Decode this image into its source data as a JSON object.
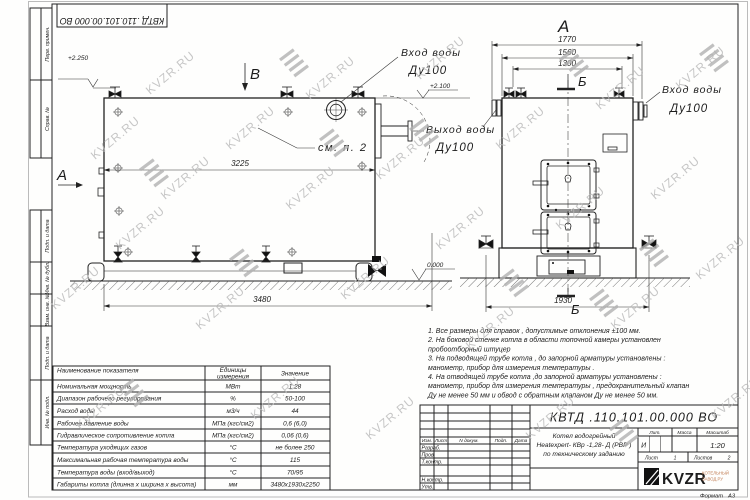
{
  "watermark": {
    "text": "KVZR.RU"
  },
  "margin_labels": [
    "Перв. примен.",
    "Справ. №",
    "Подп. и дата",
    "Инв. № дубл.",
    "Взам. инв. №",
    "Подп. и дата",
    "Инв. № подл."
  ],
  "views": {
    "a": "А",
    "b": "В",
    "sec_b": "Б",
    "callout_see_item2": "см. п. 2"
  },
  "pipe_labels": {
    "inlet": {
      "l1": "Вход воды",
      "l2": "Ду100"
    },
    "outlet": {
      "l1": "Выход воды",
      "l2": "Ду100"
    }
  },
  "elevations": {
    "vent_top": "+2.250",
    "body_top": "+2.100",
    "ground": "0.000"
  },
  "dims": {
    "body_length": "3225",
    "overall_length": "3480",
    "flange_span": "1770",
    "body_width": "1560",
    "vent_span": "1300",
    "base_span": "1930"
  },
  "notes": {
    "lines": [
      "1.  Все размеры для справок , допустимые отклонения  ±100 мм.",
      "2.  На боковой стенке котла в области топочной камеры установлен",
      "пробоотборный штуцер",
      "3.  На подводящей трубе котла , до запорной арматуры установлены :",
      "манометр, прибор для измерения температуры .",
      "4.  На отводящей трубе котла ,до запорной арматуры установлены :",
      "манометр, прибор для измерения температуры ,  предохранительный клапан",
      "Ду не менее  50 мм и обвод с обратным клапаном  Ду не менее  50 мм."
    ]
  },
  "spec_table": {
    "headers": {
      "name": "Наименование показателя",
      "units_1": "Единицы",
      "units_2": "измерения",
      "value": "Значение"
    },
    "rows": [
      {
        "n": "Номинальная мощность",
        "u": "МВт",
        "v": "1,28"
      },
      {
        "n": "Диапазон рабочего регулирования",
        "u": "%",
        "v": "50-100"
      },
      {
        "n": "Расход воды",
        "u": "м3/ч",
        "v": "44"
      },
      {
        "n": "Рабочее давление воды",
        "u": "МПа (кгс/см2)",
        "v": "0,6 (6,0)"
      },
      {
        "n": "Гидравлическое сопротивление котла",
        "u": "МПа (кгс/см2)",
        "v": "0,06 (0,6)"
      },
      {
        "n": "Температура уходящих газов",
        "u": "°С",
        "v": "не более 250"
      },
      {
        "n": "Максимальная рабочая температура воды",
        "u": "°С",
        "v": "115"
      },
      {
        "n": "Температура воды (вход/выход)",
        "u": "°С",
        "v": "70/95"
      },
      {
        "n": "Габариты котла (длинна х ширина х высота)",
        "u": "мм",
        "v": "3480х1930х2250"
      }
    ]
  },
  "title_block": {
    "doc_number": "КВТД .110.101.00.000  ВО",
    "rev_cols": [
      "Изм.",
      "Лист",
      "N докум.",
      "Подп.",
      "Дата"
    ],
    "sig_labels": [
      "Разраб.",
      "Пров.",
      "Т.контр.",
      "Н.контр.",
      "Утв."
    ],
    "name_lines": [
      "Котел водогрейный",
      "Heatexpert- КВр -1,28- Д (РВР )",
      "по техническому заданию"
    ],
    "lit_label": "Лит.",
    "lit_value": "И",
    "mass_label": "Масса",
    "scale_label": "Масштаб",
    "scale_value": "1:20",
    "sheet_label": "Лист",
    "sheet_value": "1",
    "sheets_label": "Листов",
    "sheets_value": "2",
    "logo_text": "KVZR",
    "logo_sub1": "КОТЕЛЬНЫЙ",
    "logo_sub2": "ЗАВОД.РУ",
    "format_label": "Формат",
    "format_value": "А3"
  }
}
